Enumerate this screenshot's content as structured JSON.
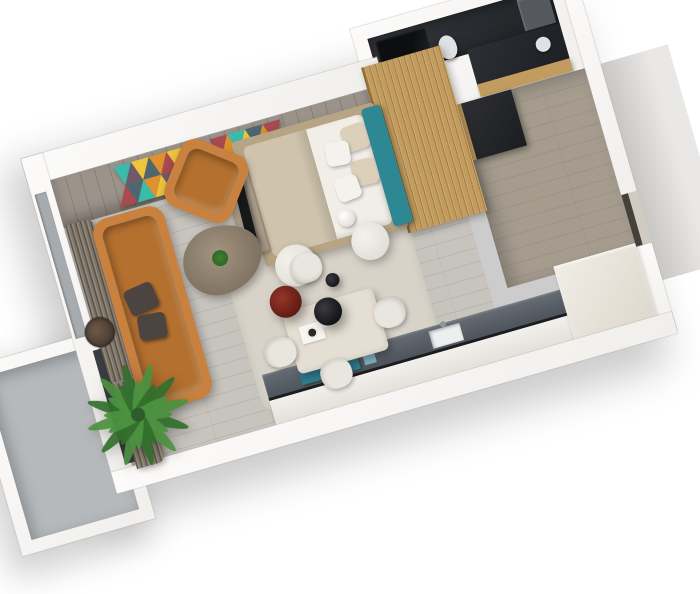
{
  "scene": {
    "description": "3D rendered top-down perspective floor plan of a small studio apartment",
    "rooms": [
      "living-room",
      "bedroom-nook",
      "bathroom",
      "entry-hall",
      "kitchen",
      "balcony"
    ],
    "inventory": [
      "orange leather sofa",
      "orange leather armchair",
      "wood slab coffee table",
      "double bed with teal headboard",
      "wood slat wardrobe wall",
      "brick accent wall",
      "two geometric triangle artworks",
      "palm plant",
      "dining table with four white chairs",
      "red pendant lamp",
      "black pendant lamp",
      "kitchen counter with teal trays",
      "white round side tables",
      "dark tiled bathroom with shower and toilet",
      "entry closet",
      "pleated curtains",
      "balcony with concrete floor",
      "round woven wall decor"
    ]
  },
  "colors": {
    "background": "#ffffff",
    "wallEdge": "#d8d6d2",
    "floorLiving": "#c7c3bd",
    "rug": "#d8d3c8",
    "brick": "#9c938a",
    "artTeal": "#3bbcab",
    "artYellow": "#eec53e",
    "artOrange": "#e0912f",
    "artRed": "#a84a50",
    "artPlum": "#6f5a6c",
    "artSlate": "#4e6670",
    "sofaOrange": "#c8813e",
    "sofaSeat": "#b4702f",
    "cushionDark": "#4b4441",
    "woodSlat": "#c29b5f",
    "headboardTeal": "#2d8894",
    "bedLinen": "#f1eee7",
    "bedBlanket": "#cfc3ad",
    "pillowBeige": "#dcd0ba",
    "pillowWhite": "#f4f2ec",
    "bedPlatform": "#b7a485",
    "benchTaupe": "#a79a89",
    "tvBlack": "#17181a",
    "bathFloor": "#303338",
    "showerBlack": "#0d0e10",
    "fixtureLight": "#dfe2e4",
    "entryFloor": "#a59c8e",
    "closetDark": "#26282b",
    "kitchenTop": "#5a6067",
    "kitchenTeal": "#2f7b8b",
    "kitchenTealLight": "#7fb3c0",
    "kitchenFront": "#ebe9e4",
    "creamCabinet": "#e8e4da",
    "tableTop": "#e5dfd3",
    "chairWhite": "#e9e6df",
    "pendantRed": "#7c241c",
    "pendantBlack": "#222226",
    "stoolWhite": "#edeae5",
    "balconyFloor": "#b5b9bc",
    "glassDark": "#3a3d41",
    "windowGlass": "#a7abae",
    "curtain": "#7f7567",
    "curtainLight": "#8a7f70",
    "palmGreen": "#4c9140",
    "palmDark": "#33702c",
    "palmCore": "#2e5c28",
    "coffeeWood": "#8f8173",
    "decorBrown": "#53453c",
    "landing": "#d7d5d2",
    "doorSlit": "#45403a"
  }
}
